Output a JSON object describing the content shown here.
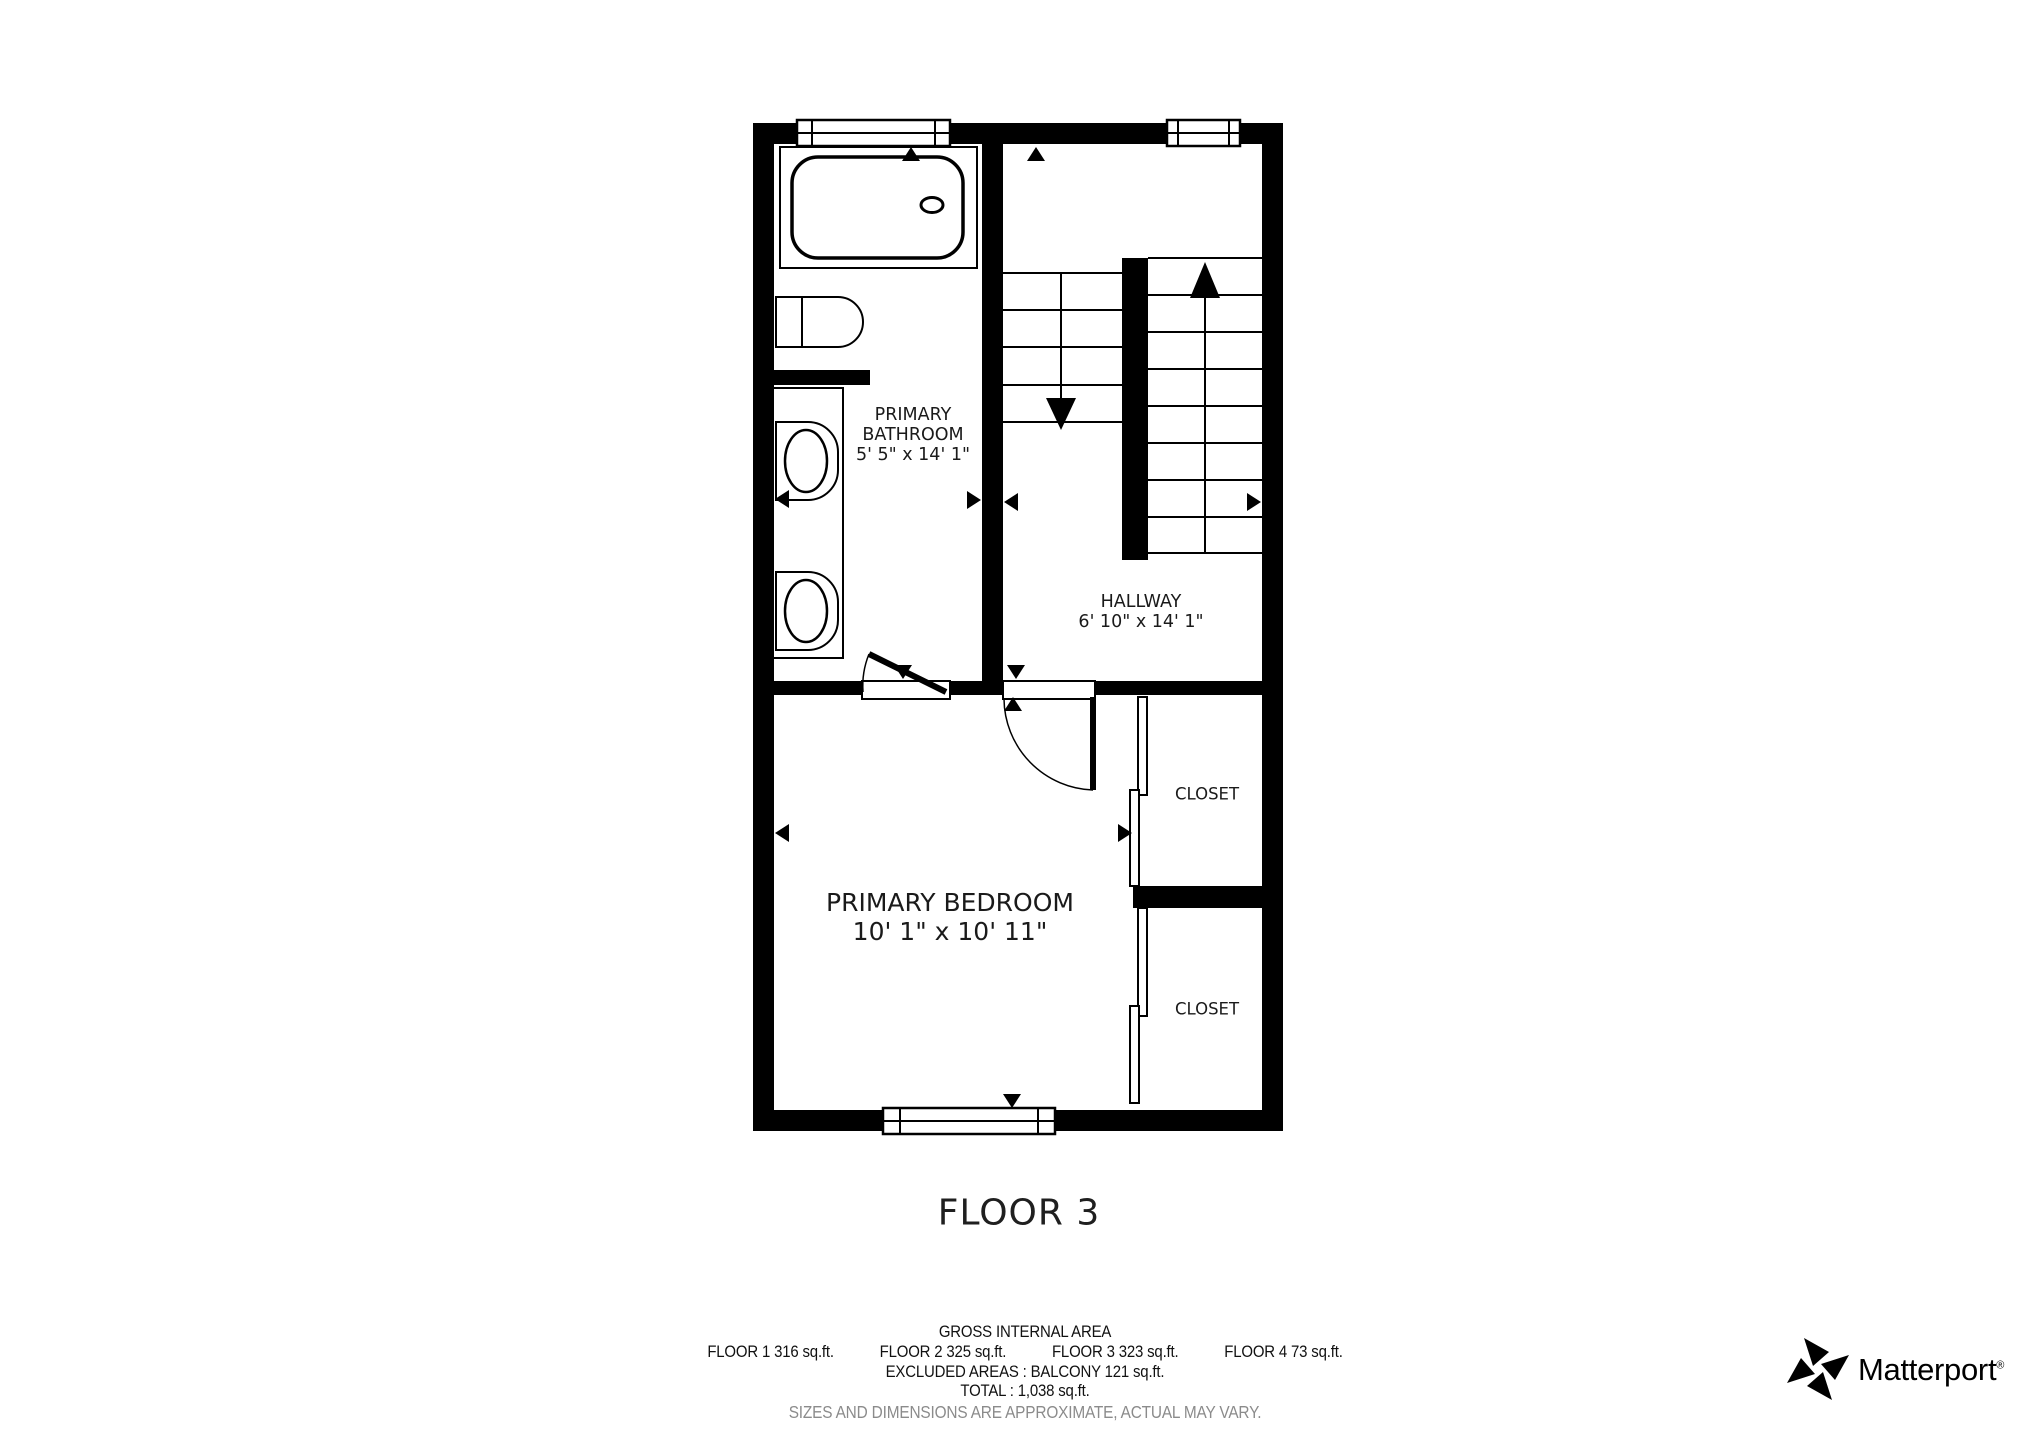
{
  "page": {
    "background": "#ffffff",
    "floor_title": "FLOOR 3"
  },
  "colors": {
    "wall": "#000000",
    "floor": "#ffffff",
    "label_text": "#1a1a1a",
    "footer_text": "#111111",
    "disclaimer_text": "#8b8b8b"
  },
  "labels": {
    "bathroom": {
      "line1": "PRIMARY",
      "line2": "BATHROOM",
      "dims": "5' 5\" x 14' 1\""
    },
    "hallway": {
      "line1": "HALLWAY",
      "dims": "6' 10\" x 14' 1\""
    },
    "bedroom": {
      "line1": "PRIMARY BEDROOM",
      "dims": "10' 1\" x 10' 11\""
    },
    "closet_top": {
      "line1": "CLOSET"
    },
    "closet_bottom": {
      "line1": "CLOSET"
    }
  },
  "footer": {
    "gross_title": "GROSS INTERNAL AREA",
    "floor_areas": [
      "FLOOR 1 316 sq.ft.",
      "FLOOR 2 325 sq.ft.",
      "FLOOR 3 323 sq.ft.",
      "FLOOR 4 73 sq.ft."
    ],
    "excluded": "EXCLUDED AREAS :  BALCONY 121 sq.ft.",
    "total": "TOTAL :  1,038 sq.ft.",
    "disclaimer": "SIZES AND DIMENSIONS ARE APPROXIMATE, ACTUAL MAY VARY."
  },
  "brand": {
    "name": "Matterport",
    "registered": "®"
  },
  "icons": {
    "matterport_mark": "pinwheel-logo",
    "stairs_up_arrow": "triangle-up",
    "stairs_down_arrow": "triangle-down",
    "dimension_arrows": "small-triangles-at-walls"
  }
}
